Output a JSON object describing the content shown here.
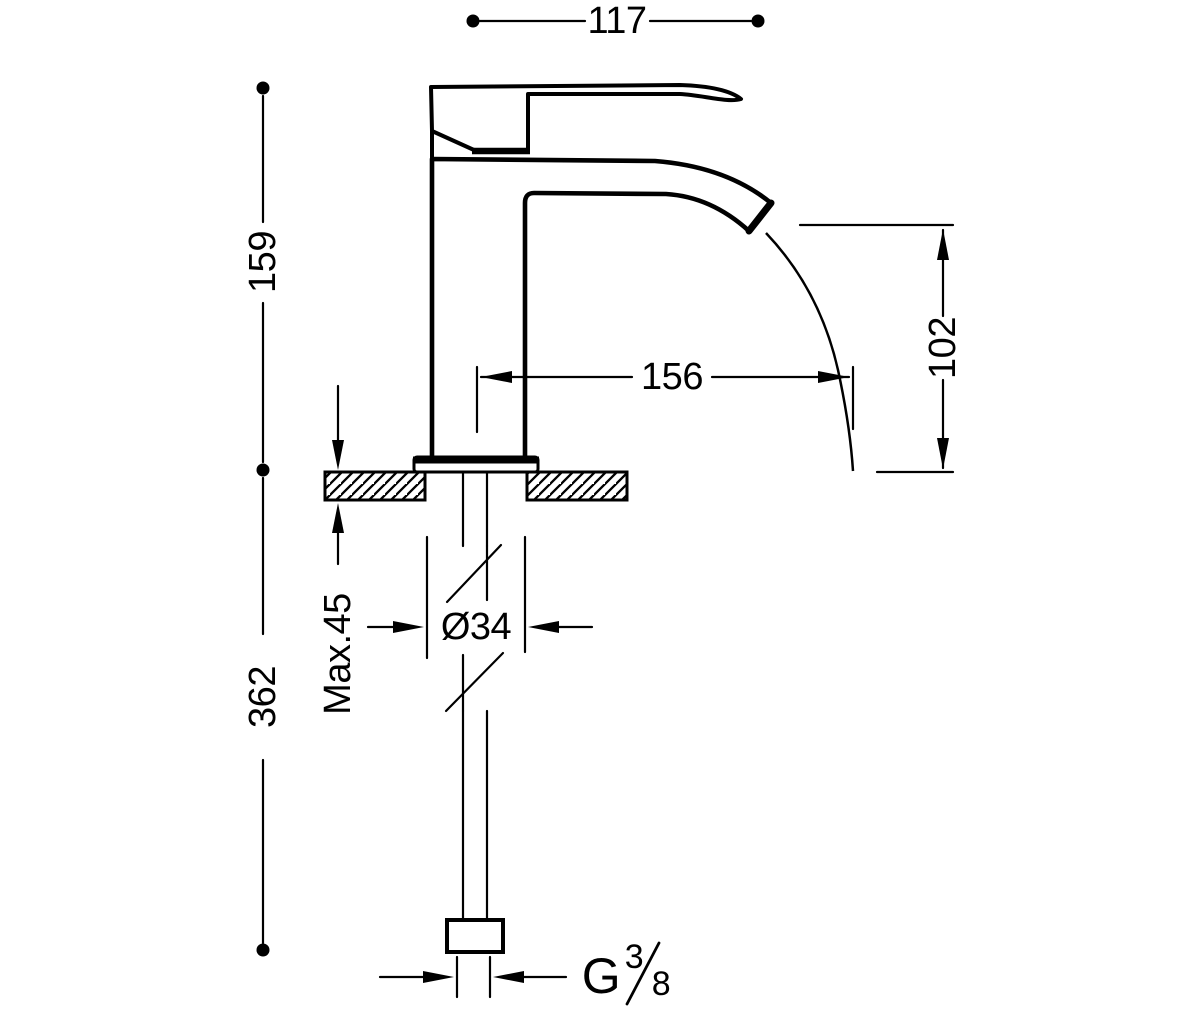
{
  "drawing": {
    "colors": {
      "line": "#000000",
      "background": "#ffffff"
    },
    "dimensions": {
      "spout_reach": "117",
      "height_to_spout": "159",
      "total_height_below": "362",
      "stream_projection": "156",
      "outlet_height": "102",
      "max_deck_thickness": "Max.45",
      "hole_diameter": "Ø34",
      "thread_letter": "G",
      "thread_numerator": "3",
      "thread_denominator": "8"
    }
  }
}
